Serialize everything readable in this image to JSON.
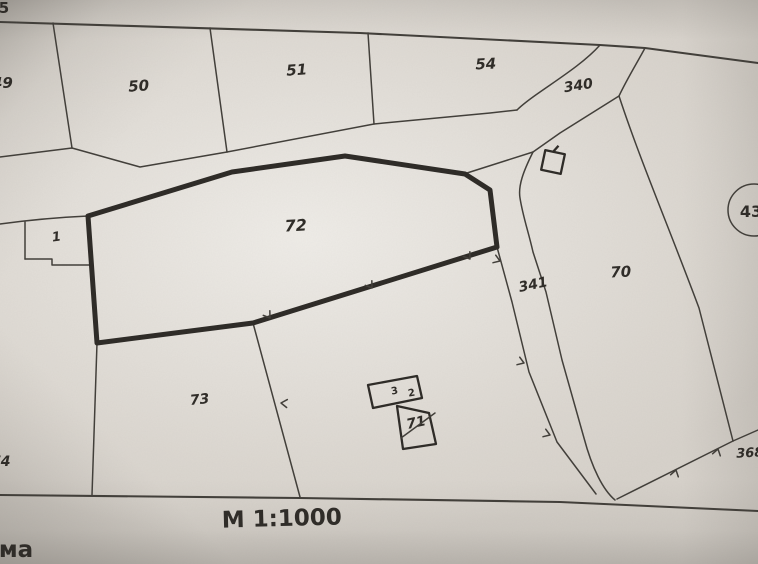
{
  "map": {
    "scale_label": "M 1:1000",
    "corner_text": "ма",
    "top_edge_partial_label": "5",
    "parcel_labels": {
      "p49": "49",
      "p50": "50",
      "p51": "51",
      "p54": "54",
      "p1": "1",
      "p72": "72",
      "p73": "73",
      "p74": "74",
      "p70": "70",
      "p71": "71"
    },
    "road_labels": {
      "r340": "340",
      "r341": "341"
    },
    "other_labels": {
      "p368": "368",
      "circled_43": "43"
    },
    "building_labels": {
      "b3": "3",
      "b2": "2"
    },
    "colors": {
      "paper": "#d7d2cb",
      "line": "#413e39",
      "bold_line": "#2d2a26",
      "text": "#2e2b27"
    }
  }
}
